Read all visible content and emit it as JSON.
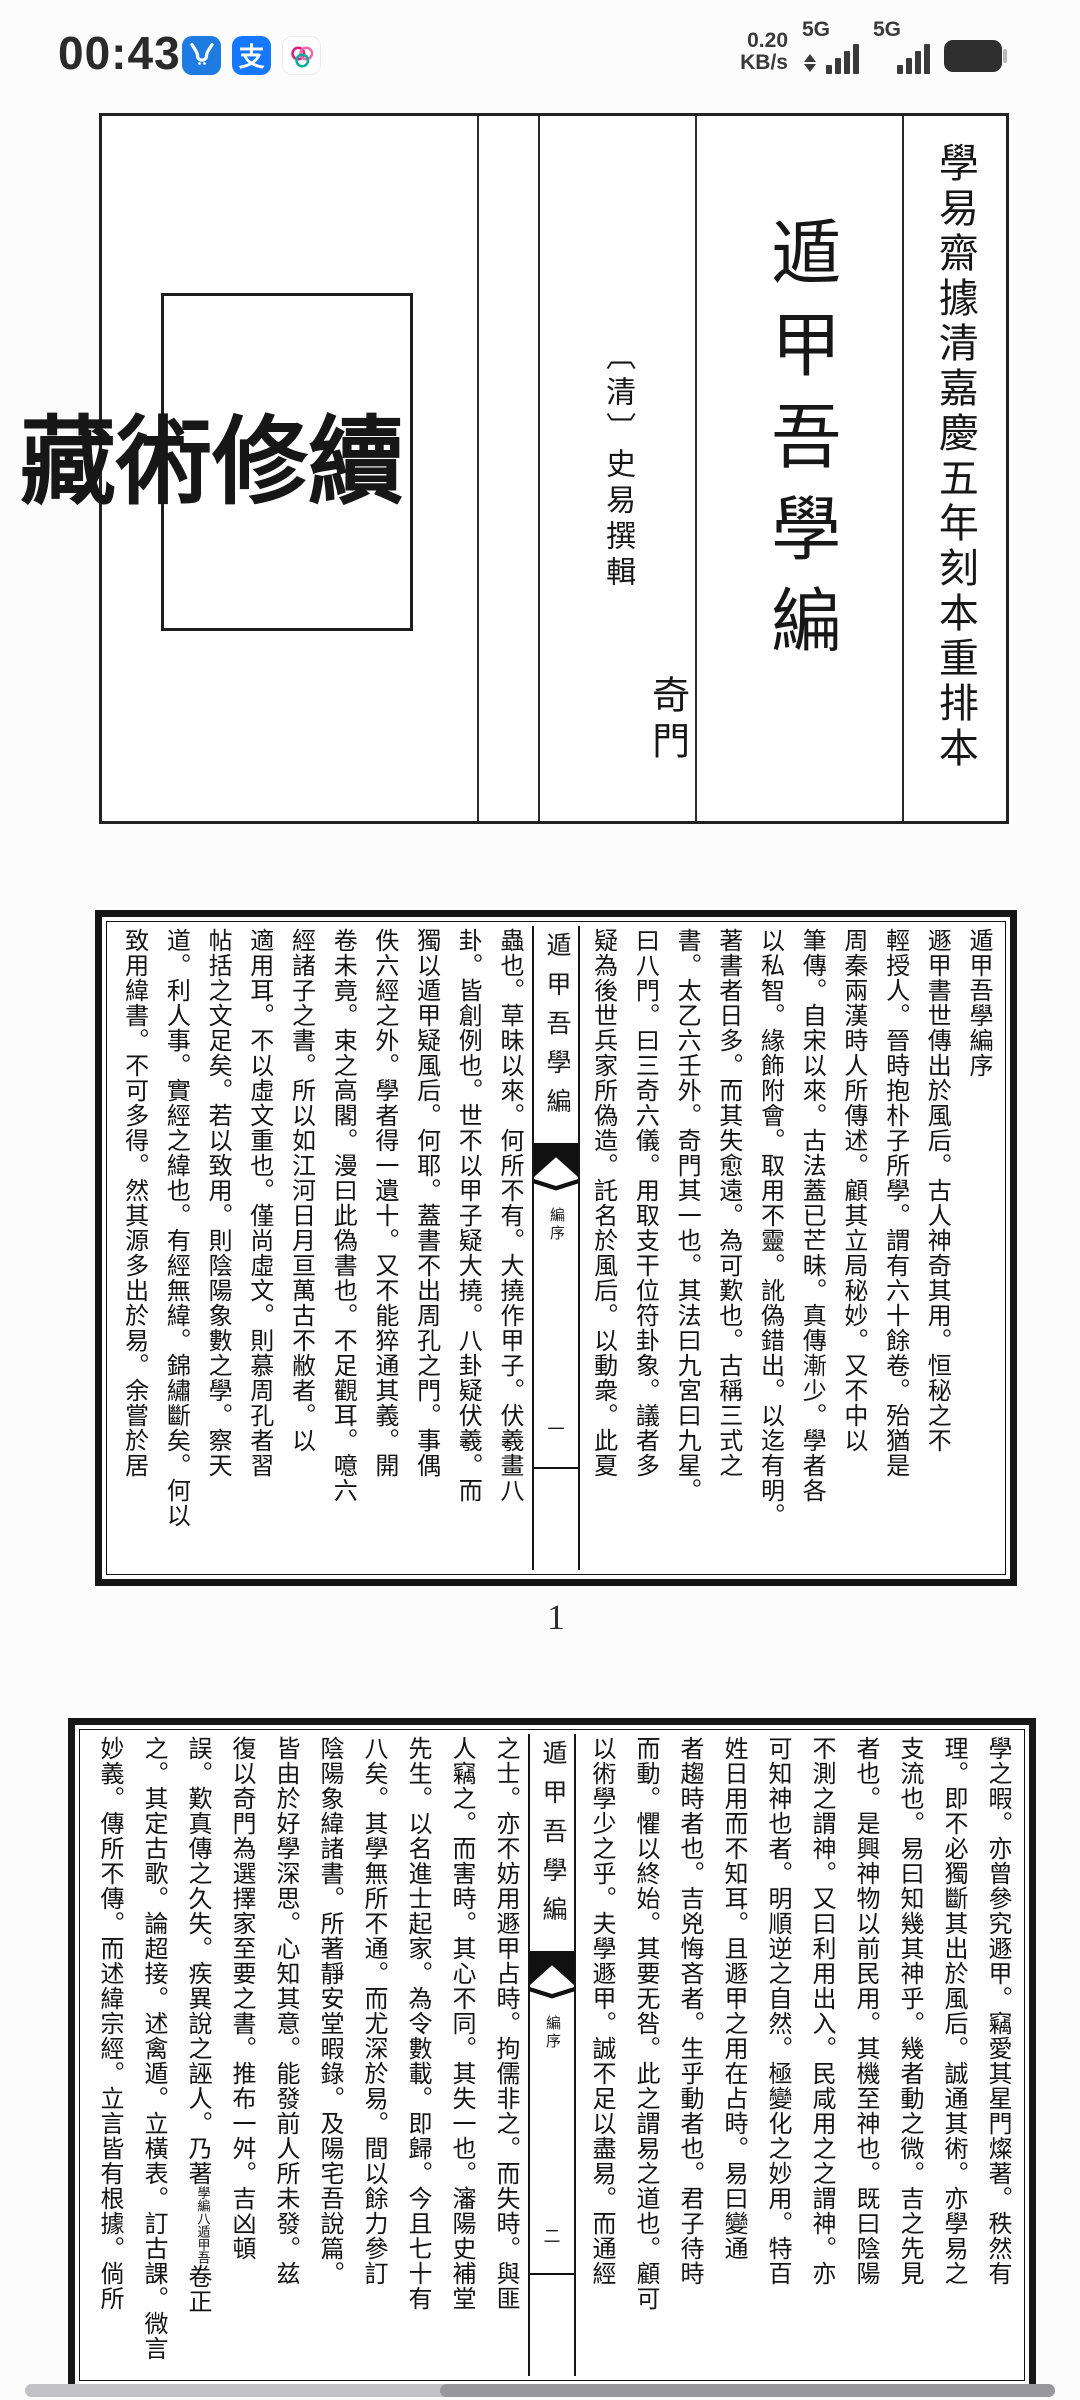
{
  "status_bar": {
    "time": "00:43",
    "app_icons": [
      "bull-app-icon",
      "alipay-app-icon",
      "petals-app-icon"
    ],
    "alipay_glyph": "支",
    "network_speed_value": "0.20",
    "network_speed_unit": "KB/s",
    "sim1_label": "5G",
    "sim2_label": "5G"
  },
  "colors": {
    "ink": "#161616",
    "bull_blue": "#1e7be0",
    "alipay_blue": "#1677ff",
    "petal_pink": "#d81e7b",
    "petal_teal": "#10ac9b",
    "scrollbar_track": "#c2c1c6",
    "scrollbar_thumb": "#98979c"
  },
  "title_page": {
    "edition_note": "學易齋據清嘉慶五年刻本重排本",
    "title": "遁甲吾學編",
    "author": "〔清〕史易撰輯",
    "category": "奇門",
    "seal_chars": [
      "續",
      "修",
      "術",
      "藏"
    ]
  },
  "page1": {
    "spine": {
      "title": "遁甲吾學編",
      "section_label": "編序",
      "folio": "一"
    },
    "footer_page_number": "1",
    "right_columns": [
      "遁甲吾學編序",
      "遯甲書世傳出於風后。古人神奇其用。恒秘之不",
      "輕授人。晉時抱朴子所學。謂有六十餘卷。殆猶是",
      "周秦兩漢時人所傳述。顧其立局秘妙。又不中以",
      "筆傳。自宋以來。古法蓋已芒昧。真傳漸少。學者各",
      "以私智。緣飾附會。取用不靈。訛偽錯出。以迄有明。",
      "著書者日多。而其失愈遠。為可歎也。古稱三式之",
      "書。太乙六壬外。奇門其一也。其法曰九宮曰九星。",
      "曰八門。曰三奇六儀。用取支干位符卦象。議者多",
      "疑為後世兵家所偽造。託名於風后。以動衆。此夏"
    ],
    "left_columns": [
      "蟲也。草昧以來。何所不有。大撓作甲子。伏羲畫八",
      "卦。皆創例也。世不以甲子疑大撓。八卦疑伏羲。而",
      "獨以遁甲疑風后。何耶。蓋書不出周孔之門。事偶",
      "佚六經之外。學者得一遺十。又不能猝通其義。開",
      "卷未竟。束之高閣。漫曰此偽書也。不足觀耳。噫六",
      "經諸子之書。所以如江河日月亘萬古不敝者。以",
      "適用耳。不以虛文重也。僅尚虛文。則慕周孔者習",
      "帖括之文足矣。若以致用。則陰陽象數之學。察天",
      "道。利人事。實經之緯也。有經無緯。錦繡斷矣。何以",
      "致用緯書。不可多得。然其源多出於易。余嘗於居"
    ]
  },
  "page2": {
    "spine": {
      "title": "遁甲吾學編",
      "section_label": "編序",
      "folio": "二"
    },
    "right_columns": [
      "學之暇。亦曾參究遯甲。竊愛其星門燦著。秩然有",
      "理。即不必獨斷其出於風后。誠通其術。亦學易之",
      "支流也。易曰知幾其神乎。幾者動之微。吉之先見",
      "者也。是興神物以前民用。其機至神也。既曰陰陽",
      "不測之謂神。又曰利用出入。民咸用之之謂神。亦",
      "可知神也者。明順逆之自然。極變化之妙用。特百",
      "姓日用而不知耳。且遯甲之用在占時。易曰變通",
      "者趨時者也。吉兇悔吝者。生乎動者也。君子待時",
      "而動。懼以終始。其要无咎。此之謂易之道也。顧可",
      "以術學少之乎。夫學遯甲。誠不足以盡易。而通經"
    ],
    "left_columns": [
      "之士。亦不妨用遯甲占時。拘儒非之。而失時。與匪",
      "人竊之。而害時。其心不同。其失一也。瀋陽史補堂",
      "先生。以名進士起家。為令數載。即歸。今且七十有",
      "八矣。其學無所不通。而尤深於易。間以餘力參訂",
      "陰陽象緯諸書。所著靜安堂暇錄。及陽宅吾說篇。",
      "皆由於好學深思。心知其意。能發前人所未發。兹",
      "復以奇門為選擇家至要之書。推布一舛。吉凶頓",
      {
        "pre": "誤。歎真傳之久失。疾異說之誣人。乃著",
        "small": [
          "遁甲吾",
          "學編八"
        ],
        "post": "卷正"
      },
      "之。其定古歌。論超接。述禽遁。立橫表。訂古課。微言",
      "妙義。傳所不傳。而述緯宗經。立言皆有根據。倘所"
    ]
  }
}
